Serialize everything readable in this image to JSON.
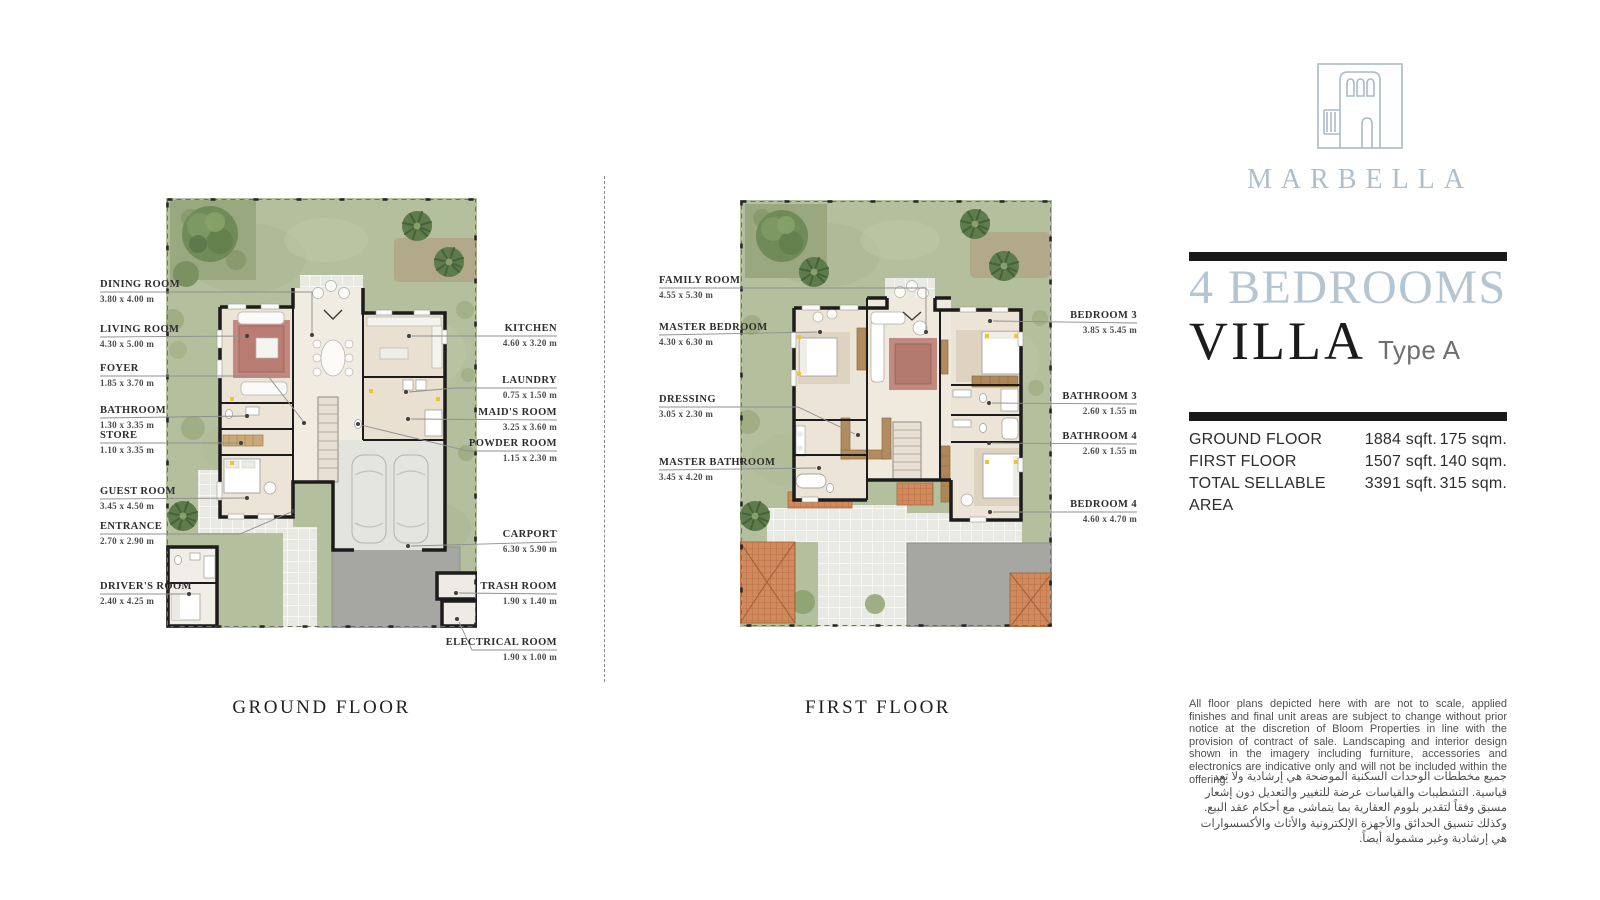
{
  "brand": {
    "name": "MARBELLA"
  },
  "title": {
    "heading": "4 BEDROOMS",
    "subheading": "VILLA",
    "type_label": "Type A"
  },
  "area_table": {
    "rows": [
      {
        "label": "GROUND FLOOR",
        "sqft": "1884 sqft.",
        "sqm": "175 sqm."
      },
      {
        "label": "FIRST FLOOR",
        "sqft": "1507 sqft.",
        "sqm": "140 sqm."
      },
      {
        "label": "TOTAL SELLABLE AREA",
        "sqft": "3391 sqft.",
        "sqm": "315 sqm."
      }
    ]
  },
  "ground_floor": {
    "caption": "GROUND FLOOR",
    "labels_left": [
      {
        "name": "DINING ROOM",
        "dims": "3.80 x 4.00 m"
      },
      {
        "name": "LIVING ROOM",
        "dims": "4.30 x 5.00 m"
      },
      {
        "name": "FOYER",
        "dims": "1.85 x 3.70 m"
      },
      {
        "name": "BATHROOM",
        "dims": "1.30 x 3.35 m"
      },
      {
        "name": "STORE",
        "dims": "1.10 x 3.35 m"
      },
      {
        "name": "GUEST ROOM",
        "dims": "3.45 x 4.50 m"
      },
      {
        "name": "ENTRANCE",
        "dims": "2.70 x 2.90 m"
      },
      {
        "name": "DRIVER'S ROOM",
        "dims": "2.40 x 4.25 m"
      }
    ],
    "labels_right": [
      {
        "name": "KITCHEN",
        "dims": "4.60 x 3.20 m"
      },
      {
        "name": "LAUNDRY",
        "dims": "0.75 x 1.50 m"
      },
      {
        "name": "MAID'S ROOM",
        "dims": "3.25 x 3.60 m"
      },
      {
        "name": "POWDER ROOM",
        "dims": "1.15 x 2.30 m"
      },
      {
        "name": "CARPORT",
        "dims": "6.30 x 5.90 m"
      },
      {
        "name": "TRASH ROOM",
        "dims": "1.90 x 1.40 m"
      },
      {
        "name": "ELECTRICAL ROOM",
        "dims": "1.90 x 1.00 m"
      }
    ]
  },
  "first_floor": {
    "caption": "FIRST FLOOR",
    "labels_left": [
      {
        "name": "FAMILY ROOM",
        "dims": "4.55 x 5.30 m"
      },
      {
        "name": "MASTER BEDROOM",
        "dims": "4.30 x 6.30 m"
      },
      {
        "name": "DRESSING",
        "dims": "3.05 x 2.30 m"
      },
      {
        "name": "MASTER BATHROOM",
        "dims": "3.45 x 4.20 m"
      }
    ],
    "labels_right": [
      {
        "name": "BEDROOM 3",
        "dims": "3.85 x 5.45 m"
      },
      {
        "name": "BATHROOM 3",
        "dims": "2.60 x 1.55 m"
      },
      {
        "name": "BATHROOM 4",
        "dims": "2.60 x 1.55 m"
      },
      {
        "name": "BEDROOM 4",
        "dims": "4.60 x 4.70 m"
      }
    ]
  },
  "disclaimer_en": "All floor plans depicted here with are not to scale, applied finishes and final unit areas are subject to change without prior notice at the discretion of Bloom Properties in line with the provision of contract of sale. Landscaping and interior design shown in the imagery including furniture, accessories and electronics are indicative only and will not be included within the offering.",
  "disclaimer_ar": "جميع مخططات الوحدات السكنية الموضحة هي إرشادية ولا تعد قياسية. التشطيبات والقياسات عرضة للتغيير والتعديل دون إشعار مسبق وفقاً لتقدير بلووم العقارية بما يتماشى مع أحكام عقد البيع. وكذلك تنسيق الحدائق والأجهزة الإلكترونية والأثاث والأكسسوارات هي إرشادية وغير مشمولة أيضاً.",
  "colors": {
    "accent_blue": "#b6c5d2",
    "bar_black": "#191919",
    "lawn_green": "#b4bf9e",
    "terracotta": "#d28a5c"
  }
}
